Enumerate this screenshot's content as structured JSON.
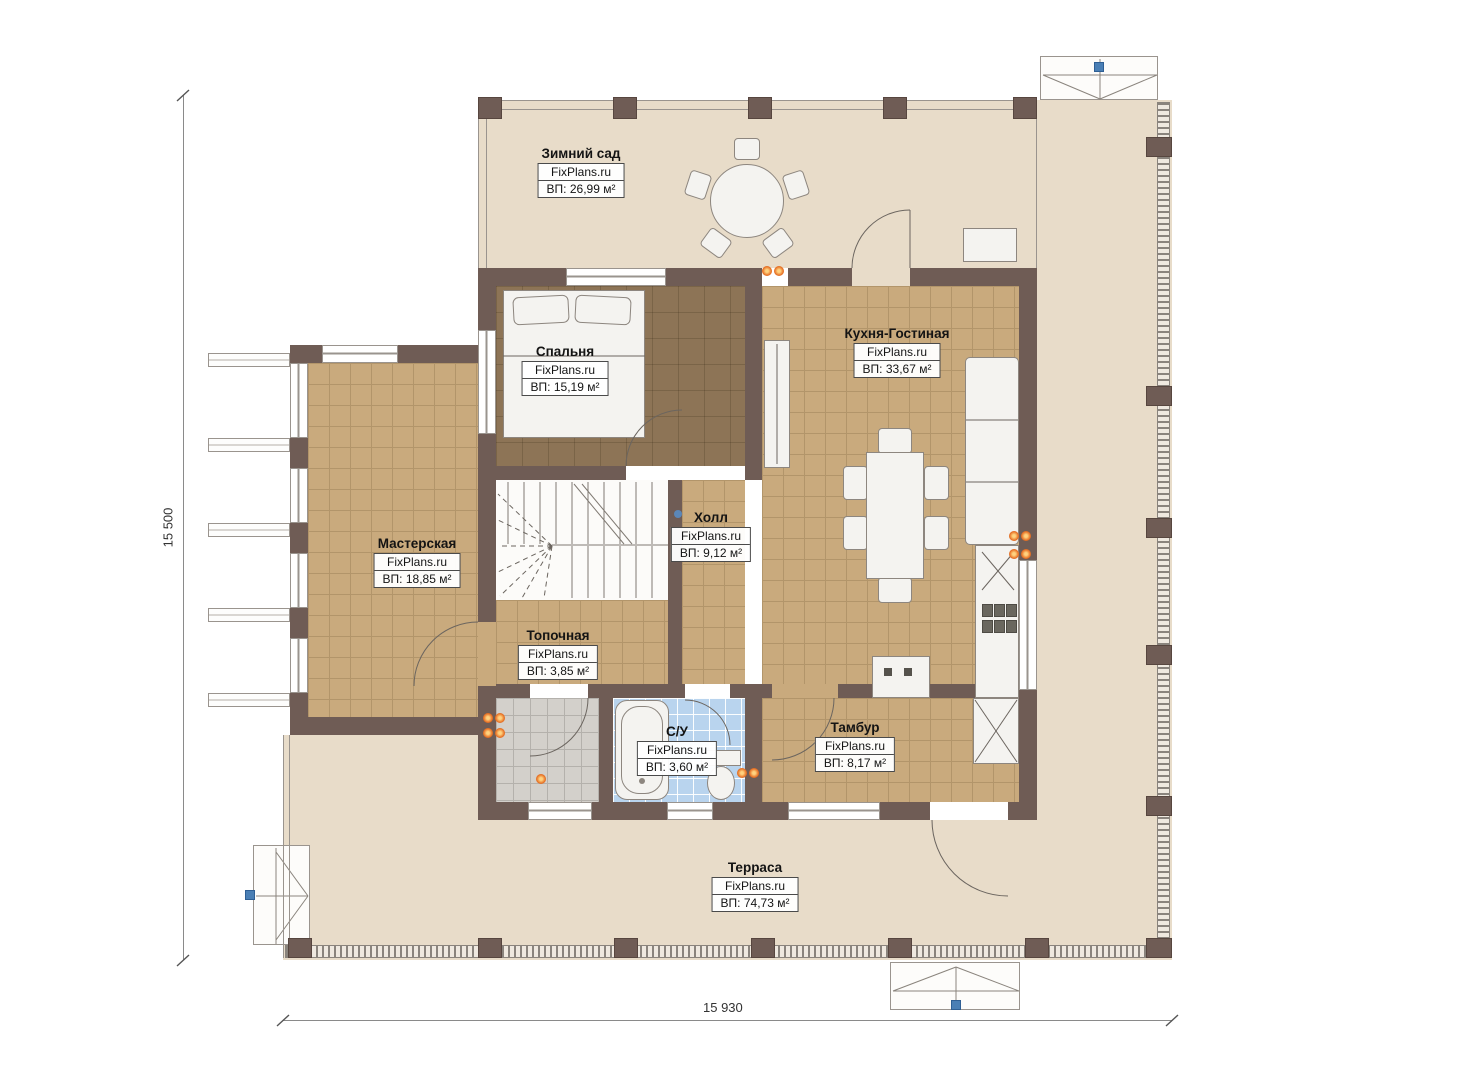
{
  "plan": {
    "source": "FixPlans.ru",
    "dimensions": {
      "height": "15 500",
      "width": "15 930"
    }
  },
  "rooms": [
    {
      "key": "winter-garden",
      "name": "Зимний сад",
      "brand": "FixPlans.ru",
      "area": "ВП: 26,99 м²"
    },
    {
      "key": "bedroom",
      "name": "Спальня",
      "brand": "FixPlans.ru",
      "area": "ВП: 15,19 м²"
    },
    {
      "key": "kitchen-living",
      "name": "Кухня-Гостиная",
      "brand": "FixPlans.ru",
      "area": "ВП: 33,67 м²"
    },
    {
      "key": "workshop",
      "name": "Мастерская",
      "brand": "FixPlans.ru",
      "area": "ВП: 18,85 м²"
    },
    {
      "key": "hall",
      "name": "Холл",
      "brand": "FixPlans.ru",
      "area": "ВП: 9,12 м²"
    },
    {
      "key": "boiler-room",
      "name": "Топочная",
      "brand": "FixPlans.ru",
      "area": "ВП: 3,85 м²"
    },
    {
      "key": "bathroom",
      "name": "С/У",
      "brand": "FixPlans.ru",
      "area": "ВП: 3,60 м²"
    },
    {
      "key": "vestibule",
      "name": "Тамбур",
      "brand": "FixPlans.ru",
      "area": "ВП: 8,17 м²"
    },
    {
      "key": "terrace",
      "name": "Терраса",
      "brand": "FixPlans.ru",
      "area": "ВП: 74,73 м²"
    }
  ],
  "colors": {
    "wall": "#6f5c55",
    "floor_tile_tan": "#c9aa7d",
    "floor_bedroom": "#8d7456",
    "floor_light": "#e8dcc9",
    "floor_bathroom": "#b9d4ee",
    "floor_entry": "#d3d0cb",
    "sconce_accent": "#e87428",
    "entry_marker": "#4a7fb5"
  }
}
